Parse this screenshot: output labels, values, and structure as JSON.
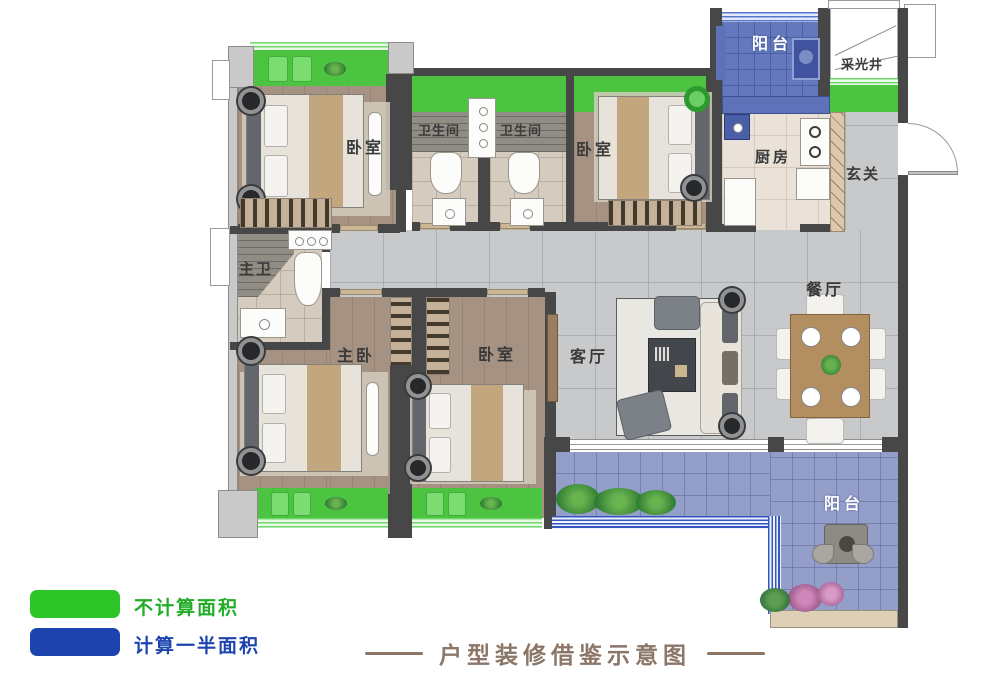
{
  "title": {
    "text": "户型装修借鉴示意图",
    "color": "#8c7668"
  },
  "legend": {
    "items": [
      {
        "label": "不计算面积",
        "swatch_color": "#2cc426",
        "label_color": "#21ad27"
      },
      {
        "label": "计算一半面积",
        "swatch_color": "#1d43ad",
        "label_color": "#1d44ae"
      }
    ]
  },
  "rooms": {
    "balcony_top": "阳台",
    "light_well": "采光井",
    "bedroom_top_left": "卧室",
    "bathroom_left": "卫生间",
    "bathroom_right": "卫生间",
    "bedroom_top_middle": "卧室",
    "kitchen": "厨房",
    "foyer": "玄关",
    "master_bathroom": "主卫",
    "dining_room": "餐厅",
    "living_room": "客厅",
    "master_bedroom": "主卧",
    "bedroom_bottom": "卧室",
    "balcony_bottom": "阳台"
  }
}
